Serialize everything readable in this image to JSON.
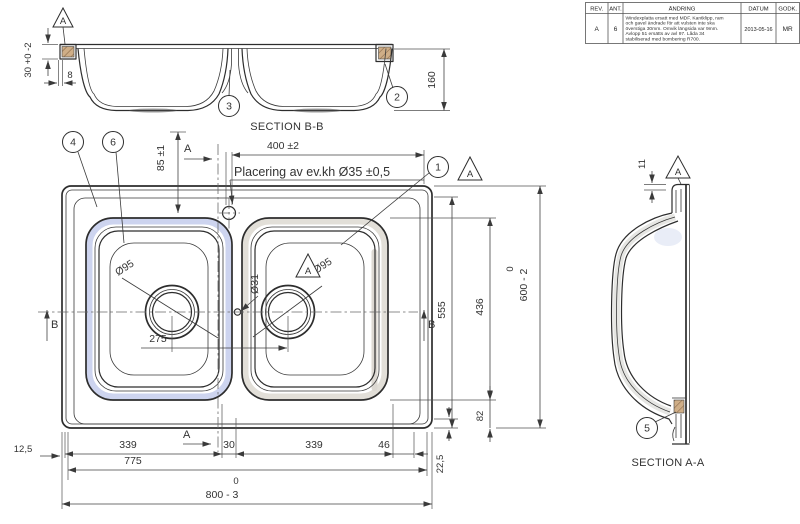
{
  "sections": {
    "bb": "SECTION B-B",
    "aa": "SECTION A-A"
  },
  "table": {
    "headers": [
      "REV.",
      "ANT.",
      "ÄNDRING",
      "DATUM",
      "GODK."
    ],
    "rev": "A",
    "ant": "6",
    "lines": [
      "Windexplatta ersatt med MDF. Kantklipp, ram",
      "och gavel ändrade för att vulsten inte ska",
      "överstiga 30mm. Omvik längsida var 9mm.",
      "Avlopp 51 ersätts av avl 97. Låda 34",
      "stabiliserad med bombering R700."
    ],
    "date": "2013-05-16",
    "approved": "MR"
  },
  "balloons": {
    "n1": "1",
    "n2": "2",
    "n3": "3",
    "n4": "4",
    "n5": "5",
    "n6": "6"
  },
  "markers": {
    "datum": "A",
    "cut_a": "A",
    "cut_b": "B"
  },
  "dims": {
    "rim30": "30 +0 -2",
    "lip8": "8",
    "h160": "160",
    "w400": "400 ±2",
    "d85": "85 ±1",
    "placering": "Placering av ev.kh  Ø35 ±0,5",
    "dia95": "Ø95",
    "dia31": "Ø31",
    "p275": "275",
    "b339": "339",
    "b30": "30",
    "b46": "46",
    "b775": "775",
    "b125": "12,5",
    "tol0": "0",
    "w800": "800 - 3",
    "r555": "555",
    "r436": "436",
    "r82": "82",
    "h600": "600 - 2",
    "r225": "22,5",
    "a11": "11"
  },
  "colors": {
    "line": "#2d2d2d",
    "bowl_band_blue": "#cdd4ef",
    "bowl_band_gray": "#e2dfd8",
    "hatch": "#cfae87"
  }
}
